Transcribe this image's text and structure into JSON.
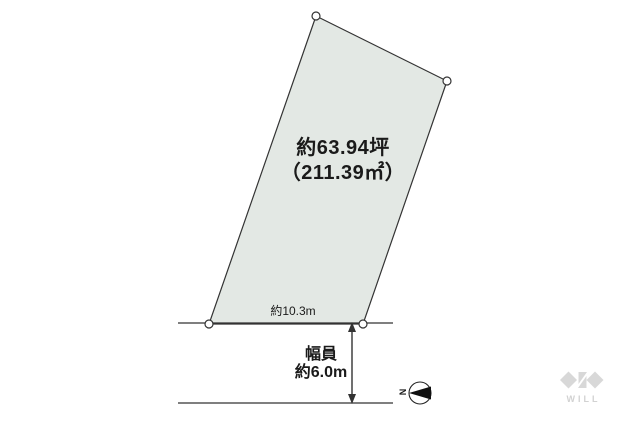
{
  "parcel": {
    "area_line1": "約63.94坪",
    "area_line2": "（211.39㎡）",
    "frontage_label": "約10.3m",
    "fill_color": "#e3e8e4",
    "outline_color": "#333333"
  },
  "road": {
    "width_label_line1": "幅員",
    "width_label_line2": "約6.0m"
  },
  "compass": {
    "north_label": "N"
  },
  "watermark": {
    "text": "WILL",
    "color": "#d6d6d6"
  }
}
